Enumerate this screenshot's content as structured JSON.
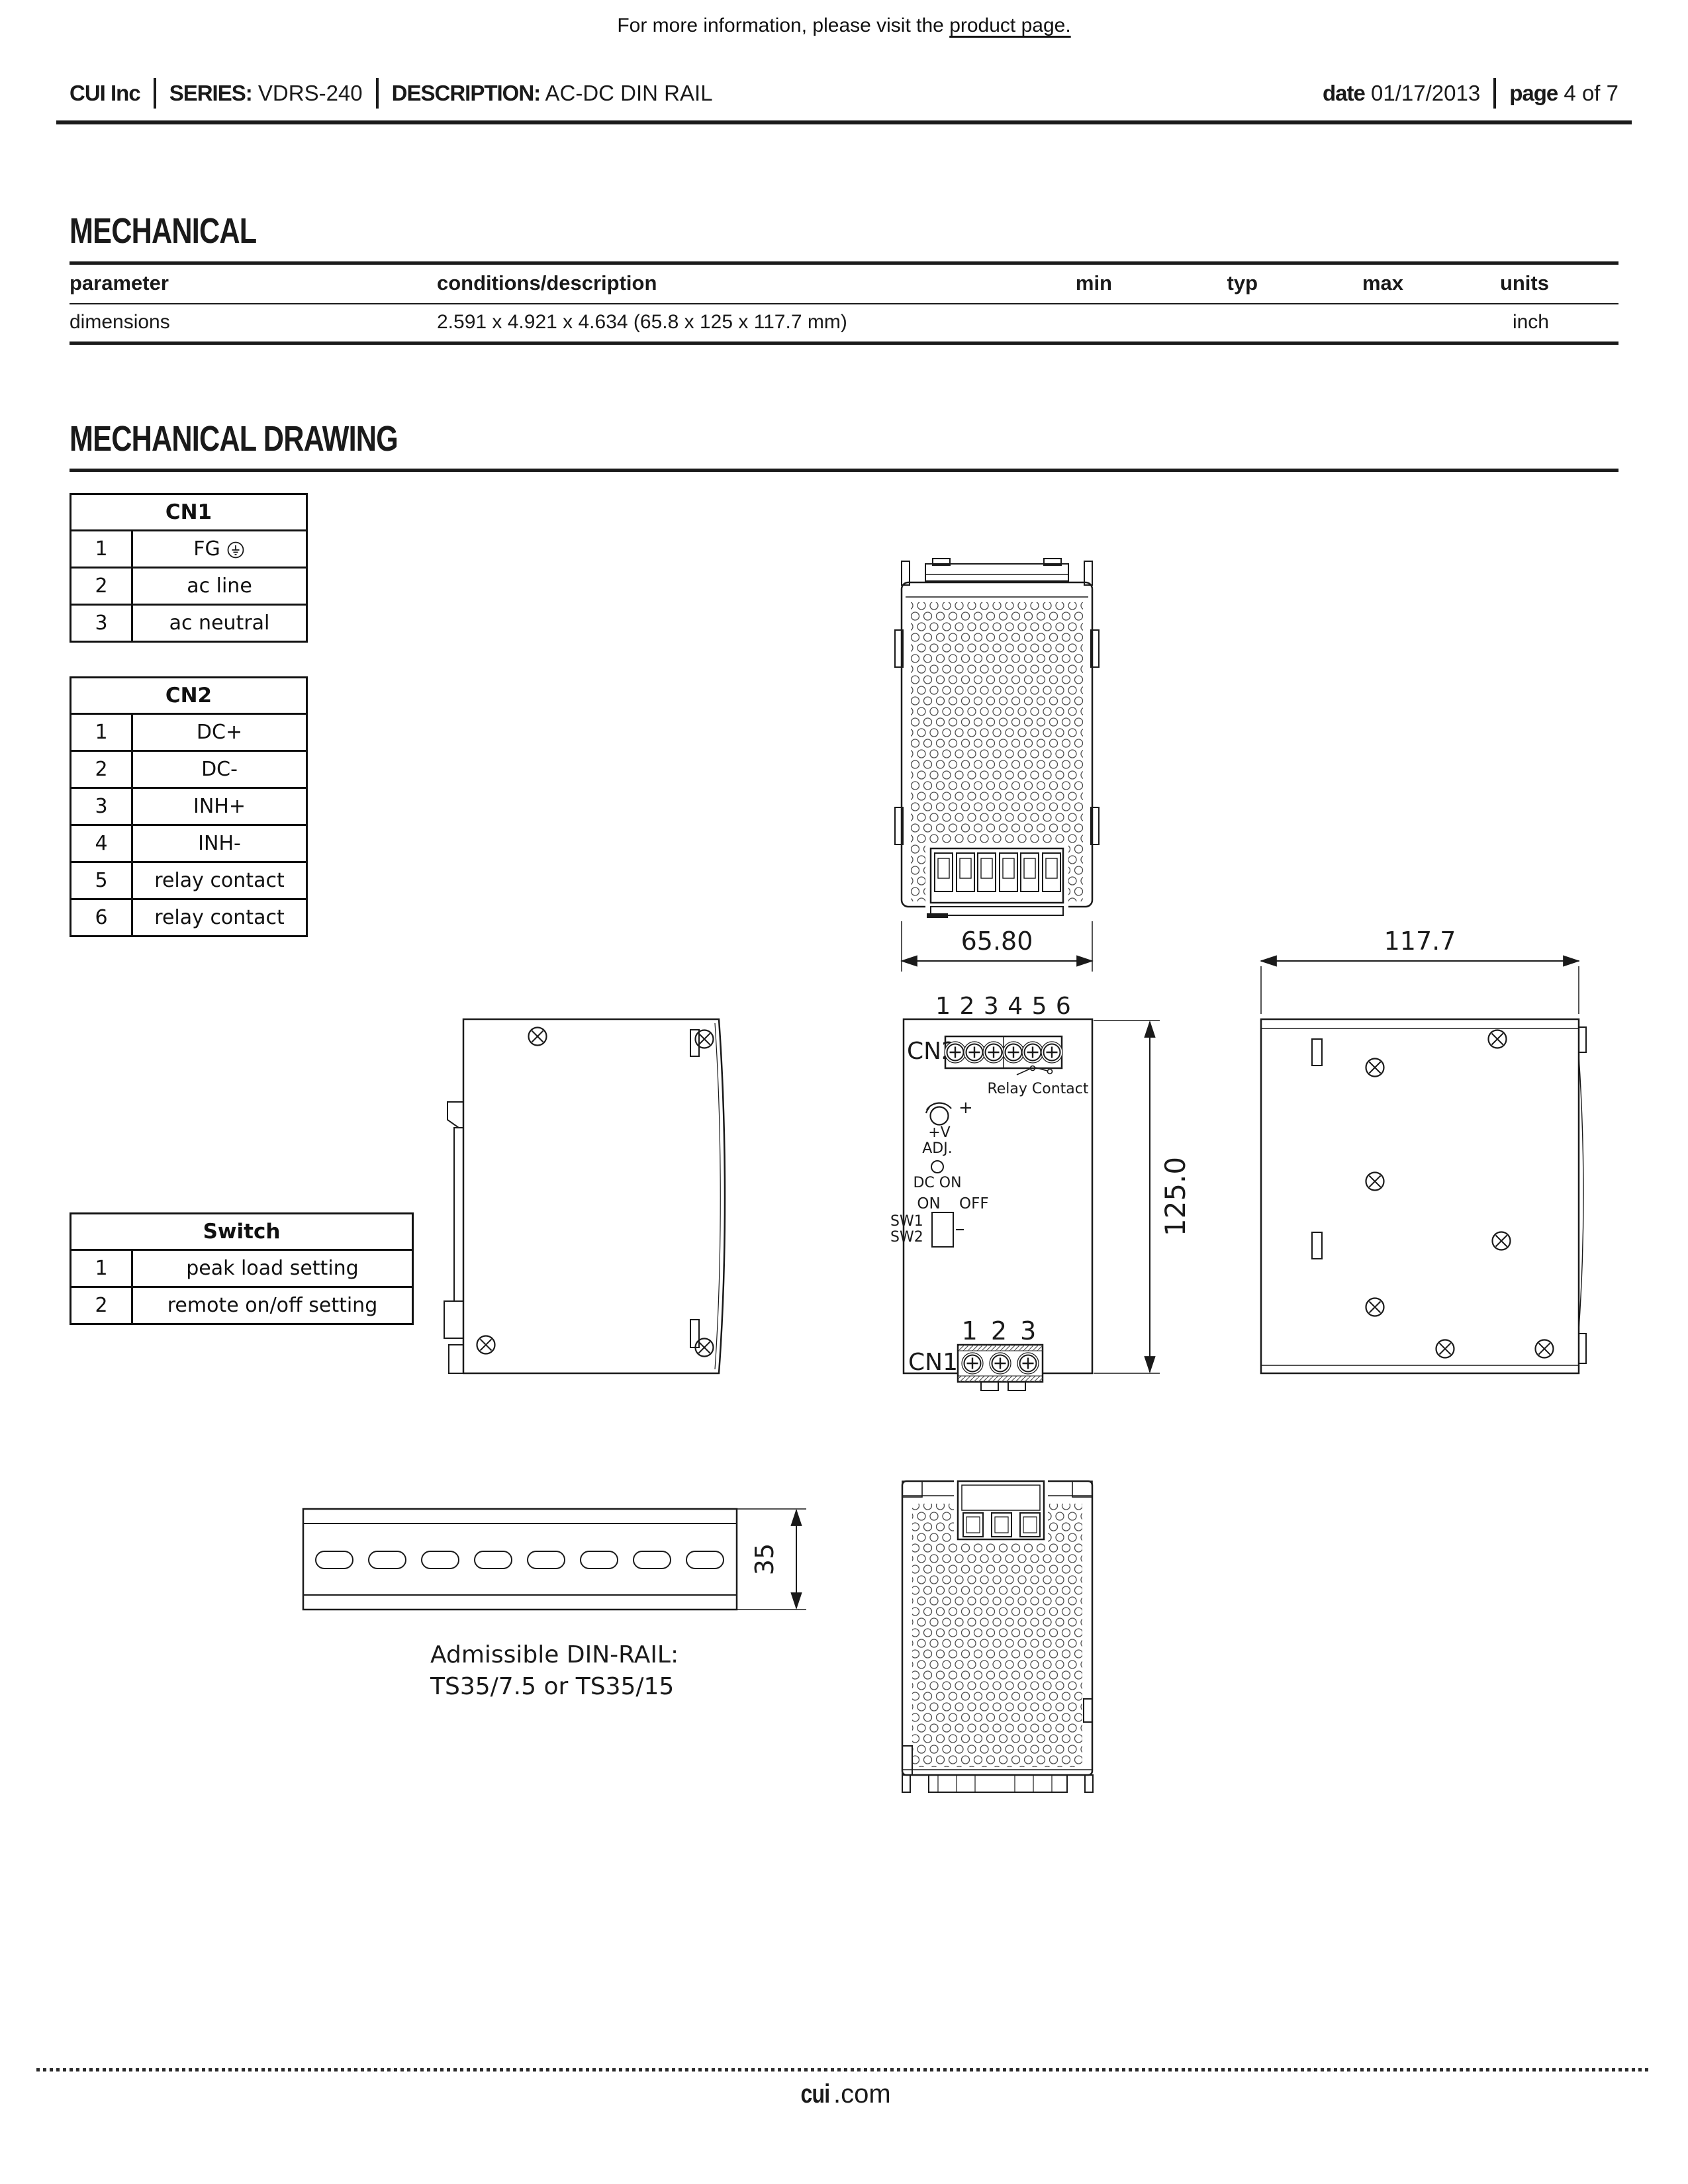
{
  "info_bar": {
    "prefix": "For more information, please visit the ",
    "link_text": "product page."
  },
  "header": {
    "company": "CUI Inc",
    "series_label": "SERIES:",
    "series_value": "VDRS-240",
    "description_label": "DESCRIPTION:",
    "description_value": "AC-DC DIN RAIL",
    "date_label": "date",
    "date_value": "01/17/2013",
    "page_label": "page",
    "page_value": "4 of 7"
  },
  "mechanical": {
    "title": "MECHANICAL",
    "columns": {
      "parameter": "parameter",
      "conditions": "conditions/description",
      "min": "min",
      "typ": "typ",
      "max": "max",
      "units": "units"
    },
    "row": {
      "parameter": "dimensions",
      "conditions": "2.591 x 4.921 x 4.634 (65.8 x 125 x 117.7 mm)",
      "min": "",
      "typ": "",
      "max": "",
      "units": "inch"
    }
  },
  "drawing": {
    "title": "MECHANICAL DRAWING",
    "cn1": {
      "title": "CN1",
      "rows": [
        {
          "pin": "1",
          "label": "FG",
          "symbol": "earth-ground"
        },
        {
          "pin": "2",
          "label": "ac line"
        },
        {
          "pin": "3",
          "label": "ac neutral"
        }
      ]
    },
    "cn2": {
      "title": "CN2",
      "rows": [
        {
          "pin": "1",
          "label": "DC+"
        },
        {
          "pin": "2",
          "label": "DC-"
        },
        {
          "pin": "3",
          "label": "INH+"
        },
        {
          "pin": "4",
          "label": "INH-"
        },
        {
          "pin": "5",
          "label": "relay contact"
        },
        {
          "pin": "6",
          "label": "relay contact"
        }
      ]
    },
    "switch": {
      "title": "Switch",
      "rows": [
        {
          "pin": "1",
          "label": "peak load setting"
        },
        {
          "pin": "2",
          "label": "remote on/off setting"
        }
      ]
    },
    "dims": {
      "width": "65.80",
      "height": "125.0",
      "depth": "117.7",
      "rail": "35"
    },
    "front": {
      "cn2_label": "CN2",
      "cn2_pins": "1 2 3 4 5 6",
      "relay_label": "Relay Contact",
      "plus": "+",
      "vadj1": "+V",
      "vadj2": "ADJ.",
      "led_label": "DC ON",
      "on": "ON",
      "off": "OFF",
      "sw1": "SW1",
      "sw2": "SW2",
      "cn1_label": "CN1",
      "cn1_pins": "1 2 3"
    },
    "rail_caption1": "Admissible DIN-RAIL:",
    "rail_caption2": "TS35/7.5 or TS35/15"
  },
  "footer": {
    "site_bold": "cui",
    "site_rest": ".com"
  }
}
